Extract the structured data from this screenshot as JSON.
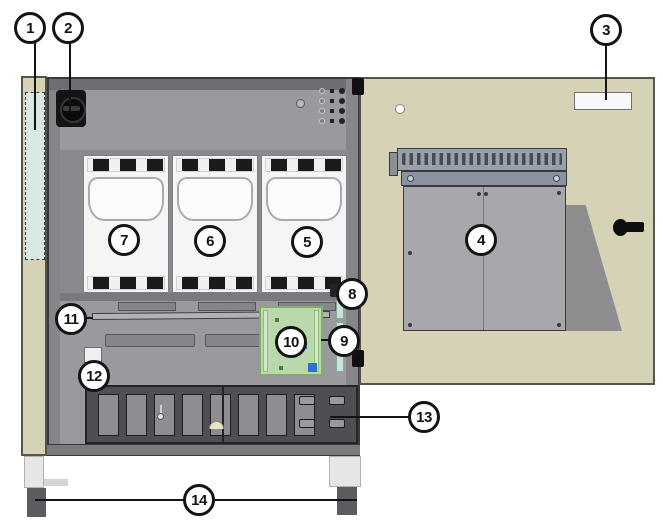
{
  "colors": {
    "page-bg": "#ffffff",
    "beige": "#d6d2b5",
    "beige-border": "#55544a",
    "teal": "#d9e8e2",
    "frame": "#85858a",
    "frame-dark": "#6e6e72",
    "panel": "#9a9a9e",
    "module-area": "#8a8a8e",
    "module-face": "#f5f5f5",
    "vent": "#1b1b1d",
    "terminal": "#4f4f53",
    "terminal-slot": "#8e8e92",
    "pcb-green": "#b9d8ab",
    "pcb-border": "#7fae6a",
    "strip-teal": "#c9e2da",
    "blue-chip": "#2f6fd0",
    "door-panel": "#a8a8ac",
    "shadow-grey": "#8e8e90",
    "leg": "#e6e6e6",
    "foot": "#5c5c60",
    "label-white": "#f8f8f8"
  },
  "callouts": [
    {
      "label": "1"
    },
    {
      "label": "2"
    },
    {
      "label": "3"
    },
    {
      "label": "4"
    },
    {
      "label": "5"
    },
    {
      "label": "6"
    },
    {
      "label": "7"
    },
    {
      "label": "8"
    },
    {
      "label": "9"
    },
    {
      "label": "10"
    },
    {
      "label": "11"
    },
    {
      "label": "12"
    },
    {
      "label": "13"
    },
    {
      "label": "14"
    }
  ]
}
